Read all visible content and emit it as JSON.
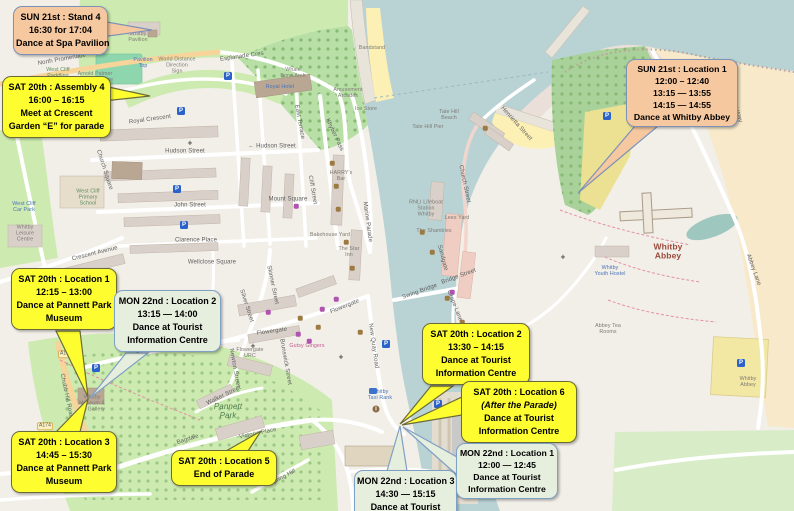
{
  "title": "Whitby festival dance locations map",
  "colors": {
    "callout_yellow": "#fdfd2f",
    "callout_sun_tan": "#f5c89f",
    "callout_mon_green": "#e6eedd",
    "water": "#b9d3d5",
    "park_green": "#cdebb0",
    "farmland_tan": "#f7e9c9",
    "beach_sand": "#fcf0b5",
    "parking_blue": "#2a62c9"
  },
  "callouts": [
    {
      "id": "sun21-stand4",
      "style": "sun",
      "lines": [
        "SUN 21st : Stand 4",
        "16:30 for 17:04",
        "Dance at Spa Pavilion"
      ]
    },
    {
      "id": "sat20-assembly4",
      "style": "yellow",
      "lines": [
        "SAT 20th : Assembly 4",
        "16:00 – 16:15",
        "Meet at Crescent",
        "Garden “E” for parade"
      ]
    },
    {
      "id": "sun21-location1",
      "style": "sun",
      "lines": [
        "SUN 21st : Location 1",
        "12:00 – 12:40",
        "13:15 — 13:55",
        "14:15 — 14:55",
        "Dance at Whitby Abbey"
      ]
    },
    {
      "id": "sat20-location1",
      "style": "yellow",
      "lines": [
        "SAT 20th : Location 1",
        "12:15 – 13:00",
        "Dance at Pannett Park",
        "Museum"
      ]
    },
    {
      "id": "mon22-location2",
      "style": "mon",
      "lines": [
        "MON 22nd : Location 2",
        "13:15 — 14:00",
        "Dance at Tourist",
        "Information Centre"
      ]
    },
    {
      "id": "sat20-location2",
      "style": "yellow",
      "lines": [
        "SAT 20th : Location 2",
        "13:30 – 14:15",
        "Dance at Tourist",
        "Information Centre"
      ]
    },
    {
      "id": "sat20-location6",
      "style": "yellow",
      "lines": [
        "SAT 20th : Location 6",
        "(After the Parade)",
        "Dance at Tourist",
        "Information Centre"
      ]
    },
    {
      "id": "sat20-location3",
      "style": "yellow",
      "lines": [
        "SAT 20th : Location 3",
        "14:45 – 15:30",
        "Dance at Pannett Park",
        "Museum"
      ]
    },
    {
      "id": "sat20-location5",
      "style": "yellow",
      "lines": [
        "SAT 20th : Location 5",
        "End of Parade"
      ]
    },
    {
      "id": "mon22-location3",
      "style": "mon",
      "lines": [
        "MON 22nd : Location 3",
        "14:30 — 15:15",
        "Dance at Tourist"
      ]
    },
    {
      "id": "mon22-location1",
      "style": "mon",
      "lines": [
        "MON 22nd : Location 1",
        "12:00 — 12:45",
        "Dance at Tourist",
        "Information Centre"
      ]
    }
  ],
  "map": {
    "town_label": "Whitby",
    "labels": [
      {
        "text": "North Promenade",
        "x": 62,
        "y": 60,
        "cls": "street",
        "rot": -10
      },
      {
        "text": "Esplanade Cres",
        "x": 242,
        "y": 57,
        "cls": "street",
        "rot": -8
      },
      {
        "text": "Whale\nBone Arch",
        "x": 293,
        "y": 74,
        "cls": "tiny"
      },
      {
        "text": "Royal Hotel",
        "x": 280,
        "y": 88,
        "cls": "tiny blue"
      },
      {
        "text": "Amusement\nArcades",
        "x": 348,
        "y": 94,
        "cls": "tiny"
      },
      {
        "text": "Ice Store",
        "x": 366,
        "y": 110,
        "cls": "tiny"
      },
      {
        "text": "Bandstand",
        "x": 372,
        "y": 49,
        "cls": "tiny"
      },
      {
        "text": "East Terrace",
        "x": 299,
        "y": 122,
        "cls": "street",
        "rot": 80
      },
      {
        "text": "Khyber Pass",
        "x": 334,
        "y": 135,
        "cls": "street",
        "rot": 65
      },
      {
        "text": "Royal Crescent",
        "x": 150,
        "y": 120,
        "cls": "street",
        "rot": -8
      },
      {
        "text": "Hudson Street",
        "x": 185,
        "y": 152,
        "cls": "street"
      },
      {
        "text": "← Hudson Street",
        "x": 272,
        "y": 147,
        "cls": "street"
      },
      {
        "text": "John Street",
        "x": 190,
        "y": 206,
        "cls": "street"
      },
      {
        "text": "Clarence Place",
        "x": 196,
        "y": 241,
        "cls": "street"
      },
      {
        "text": "Crescent Avenue",
        "x": 95,
        "y": 254,
        "cls": "street",
        "rot": -14
      },
      {
        "text": "Mount Square",
        "x": 288,
        "y": 200,
        "cls": "street"
      },
      {
        "text": "Church Square",
        "x": 104,
        "y": 170,
        "cls": "street",
        "rot": 72
      },
      {
        "text": "West Cliff\nPrimary\nSchool",
        "x": 88,
        "y": 198,
        "cls": "tiny green-t"
      },
      {
        "text": "Wellclose Square",
        "x": 212,
        "y": 263,
        "cls": "street"
      },
      {
        "text": "Cliff Street",
        "x": 312,
        "y": 190,
        "cls": "street",
        "rot": 80
      },
      {
        "text": "Skinner Street",
        "x": 272,
        "y": 285,
        "cls": "street",
        "rot": 78
      },
      {
        "text": "Silver Street",
        "x": 246,
        "y": 306,
        "cls": "street",
        "rot": 72
      },
      {
        "text": "Flowergate",
        "x": 272,
        "y": 332,
        "cls": "street",
        "rot": -8
      },
      {
        "text": "Flowergate",
        "x": 345,
        "y": 307,
        "cls": "street",
        "rot": -22
      },
      {
        "text": "Flowergate\nURC",
        "x": 250,
        "y": 354,
        "cls": "tiny"
      },
      {
        "text": "Newton Street",
        "x": 234,
        "y": 368,
        "cls": "street",
        "rot": 80
      },
      {
        "text": "Brunswick Street",
        "x": 285,
        "y": 362,
        "cls": "street",
        "rot": 80
      },
      {
        "text": "Gutsy Gingers",
        "x": 307,
        "y": 347,
        "cls": "tiny pink"
      },
      {
        "text": "St Hilda's Terrace",
        "x": 160,
        "y": 348,
        "cls": "street",
        "rot": -10
      },
      {
        "text": "Pannett\nPark",
        "x": 228,
        "y": 412,
        "cls": "park-label"
      },
      {
        "text": "Chubb Hill Road",
        "x": 66,
        "y": 396,
        "cls": "street",
        "rot": 78
      },
      {
        "text": "Walker Street",
        "x": 224,
        "y": 396,
        "cls": "street",
        "rot": -26
      },
      {
        "text": "Bagdale",
        "x": 188,
        "y": 440,
        "cls": "street",
        "rot": -18
      },
      {
        "text": "Victoria Place",
        "x": 258,
        "y": 434,
        "cls": "street",
        "rot": -12
      },
      {
        "text": "Spring Hill",
        "x": 283,
        "y": 478,
        "cls": "street",
        "rot": -28
      },
      {
        "text": "Whitby\nTaxi Rank",
        "x": 380,
        "y": 396,
        "cls": "tiny blue"
      },
      {
        "text": "New Quay Road",
        "x": 373,
        "y": 346,
        "cls": "street",
        "rot": 82
      },
      {
        "text": "Swing Bridge",
        "x": 420,
        "y": 292,
        "cls": "street",
        "rot": -20
      },
      {
        "text": "Bridge Street",
        "x": 459,
        "y": 277,
        "cls": "street",
        "rot": -20
      },
      {
        "text": "Grape Lane",
        "x": 454,
        "y": 306,
        "cls": "street",
        "rot": 68
      },
      {
        "text": "Marine Parade",
        "x": 367,
        "y": 222,
        "cls": "street",
        "rot": 82
      },
      {
        "text": "HARRY's\nBar",
        "x": 341,
        "y": 177,
        "cls": "tiny"
      },
      {
        "text": "Bakehouse Yard",
        "x": 330,
        "y": 236,
        "cls": "tiny"
      },
      {
        "text": "The Star\nInn",
        "x": 349,
        "y": 253,
        "cls": "tiny"
      },
      {
        "text": "RNLI Lifeboat\nStation\nWhitby",
        "x": 426,
        "y": 209,
        "cls": "tiny"
      },
      {
        "text": "The Shambles",
        "x": 434,
        "y": 232,
        "cls": "tiny"
      },
      {
        "text": "Lees Yard",
        "x": 457,
        "y": 219,
        "cls": "tiny"
      },
      {
        "text": "Church Street",
        "x": 464,
        "y": 184,
        "cls": "street",
        "rot": 78
      },
      {
        "text": "Sandgate",
        "x": 442,
        "y": 258,
        "cls": "street",
        "rot": 75
      },
      {
        "text": "Henrietta Street",
        "x": 516,
        "y": 124,
        "cls": "street",
        "rot": 48
      },
      {
        "text": "Tate Hill\nBeach",
        "x": 449,
        "y": 116,
        "cls": "tiny"
      },
      {
        "text": "Tate Hill Pier",
        "x": 428,
        "y": 128,
        "cls": "tiny"
      },
      {
        "text": "Whitby\nAbbey",
        "x": 668,
        "y": 252,
        "cls": "abbey-label"
      },
      {
        "text": "Whitby\nYouth Hostel",
        "x": 610,
        "y": 272,
        "cls": "tiny blue"
      },
      {
        "text": "Abbey Tea\nRooms",
        "x": 608,
        "y": 330,
        "cls": "tiny"
      },
      {
        "text": "Whitby\nAbbey",
        "x": 748,
        "y": 383,
        "cls": "tiny"
      },
      {
        "text": "Abbey Lane",
        "x": 753,
        "y": 270,
        "cls": "street",
        "rot": 70
      },
      {
        "text": "Cleveland Way",
        "x": 733,
        "y": 103,
        "cls": "street",
        "rot": 70
      },
      {
        "text": "Whitby\nPavilion",
        "x": 138,
        "y": 38,
        "cls": "tiny"
      },
      {
        "text": "Pavilion\nTop",
        "x": 143,
        "y": 64,
        "cls": "tiny blue"
      },
      {
        "text": "World Distance\nDirection\nSign",
        "x": 177,
        "y": 66,
        "cls": "tiny"
      },
      {
        "text": "Arnold Palmer\nPutting Course",
        "x": 95,
        "y": 78,
        "cls": "tiny"
      },
      {
        "text": "West Cliff\nPaddling",
        "x": 58,
        "y": 74,
        "cls": "tiny green-t"
      },
      {
        "text": "West Cliff\nCar Park",
        "x": 24,
        "y": 208,
        "cls": "tiny blue"
      },
      {
        "text": "Whitby\nLeisure\nCentre",
        "x": 25,
        "y": 234,
        "cls": "tiny"
      },
      {
        "text": "Harrison's\nGarage",
        "x": 146,
        "y": 327,
        "cls": "tiny"
      },
      {
        "text": "Whitby\nMuseum &\nArt Gallery",
        "x": 92,
        "y": 404,
        "cls": "tiny"
      },
      {
        "text": "A174",
        "x": 66,
        "y": 354,
        "cls": "shield"
      },
      {
        "text": "A174",
        "x": 45,
        "y": 426,
        "cls": "shield"
      }
    ],
    "pois": [
      {
        "type": "parking",
        "x": 228,
        "y": 76
      },
      {
        "type": "parking",
        "x": 181,
        "y": 111
      },
      {
        "type": "parking",
        "x": 177,
        "y": 189
      },
      {
        "type": "parking",
        "x": 184,
        "y": 225
      },
      {
        "type": "parking",
        "x": 96,
        "y": 368
      },
      {
        "type": "parking",
        "x": 386,
        "y": 344
      },
      {
        "type": "parking",
        "x": 438,
        "y": 404
      },
      {
        "type": "parking",
        "x": 607,
        "y": 116
      },
      {
        "type": "parking",
        "x": 741,
        "y": 363
      },
      {
        "type": "info",
        "x": 376,
        "y": 409
      },
      {
        "type": "taxi",
        "x": 373,
        "y": 391
      },
      {
        "type": "church",
        "x": 190,
        "y": 143
      },
      {
        "type": "church",
        "x": 253,
        "y": 346
      },
      {
        "type": "church",
        "x": 341,
        "y": 357
      },
      {
        "type": "church",
        "x": 563,
        "y": 257
      },
      {
        "type": "pub",
        "x": 332,
        "y": 163
      },
      {
        "type": "pub",
        "x": 336,
        "y": 186
      },
      {
        "type": "pub",
        "x": 338,
        "y": 209
      },
      {
        "type": "pub",
        "x": 346,
        "y": 242
      },
      {
        "type": "pub",
        "x": 352,
        "y": 268
      },
      {
        "type": "pub",
        "x": 300,
        "y": 318
      },
      {
        "type": "pub",
        "x": 318,
        "y": 327
      },
      {
        "type": "pub",
        "x": 360,
        "y": 332
      },
      {
        "type": "pub",
        "x": 422,
        "y": 232
      },
      {
        "type": "pub",
        "x": 432,
        "y": 252
      },
      {
        "type": "pub",
        "x": 447,
        "y": 298
      },
      {
        "type": "pub",
        "x": 462,
        "y": 322
      },
      {
        "type": "pub",
        "x": 468,
        "y": 341
      },
      {
        "type": "pub",
        "x": 485,
        "y": 128
      },
      {
        "type": "shop",
        "x": 298,
        "y": 334
      },
      {
        "type": "shop",
        "x": 309,
        "y": 341
      },
      {
        "type": "shop",
        "x": 322,
        "y": 309
      },
      {
        "type": "shop",
        "x": 336,
        "y": 299
      },
      {
        "type": "shop",
        "x": 452,
        "y": 292
      },
      {
        "type": "shop",
        "x": 296,
        "y": 206
      },
      {
        "type": "shop",
        "x": 268,
        "y": 312
      }
    ]
  }
}
